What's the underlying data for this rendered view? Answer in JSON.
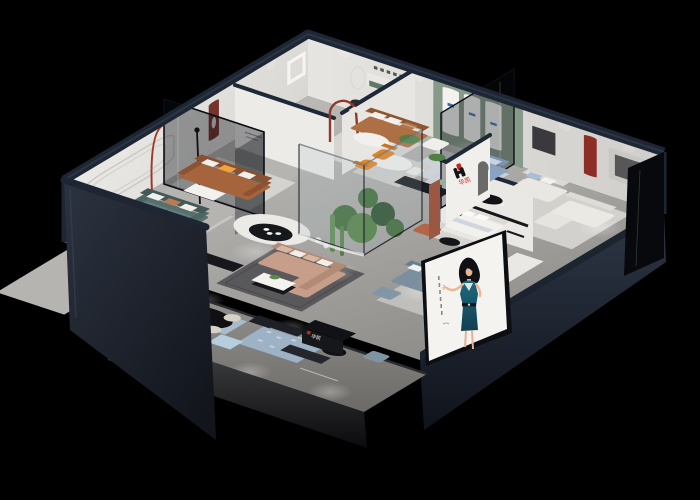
{
  "meta": {
    "title": "Furniture showroom 3D cutaway render",
    "style": "isometric dollhouse aerial view",
    "background": "#000000"
  },
  "brand": {
    "name": "华凯",
    "monogram": "geometric H mark",
    "colors": {
      "red": "#c5271f",
      "black": "#141414"
    },
    "wall_logo_text": "华凯",
    "counter_logo_text": "华凯"
  },
  "poster": {
    "subject": "fashion model illustration in teal evening dress",
    "dress_color": "#1e6a7f",
    "panel_color": "#f4f3f0",
    "location": "front-right facade"
  },
  "palette": {
    "wall_caps_navy": "#1f2836",
    "interior_walls": "#e9e8e4",
    "floor_gray": "#aaa9a6",
    "facade_dark": "#2b3342",
    "glass_tint": "#0d1117",
    "sage_wall": "#879a89",
    "maroon_niche": "#74332b",
    "terracotta": "#a6643c",
    "accent_orange": "#e08428",
    "teal_sofa": "#5b7472",
    "blush_sofa": "#c79e8a",
    "blue_sofa": "#8aa3c2",
    "brand_red": "#c5271f"
  },
  "rooms": [
    {
      "name": "teal-sofa-lounge",
      "items": "teal sofa, potted plants, round table, stadium wall relief"
    },
    {
      "name": "cognac-sofa-room",
      "items": "cognac leather sofa, maroon arch niche, black-white coffee table"
    },
    {
      "name": "top-leather-room",
      "items": "caramel sofa, green wall niche, sculpture pedestal, wall mirror"
    },
    {
      "name": "arch-gallery",
      "items": "sage wall with three arched panels, white armchair"
    },
    {
      "name": "blue-sofa-room",
      "items": "blue fabric sofa, sage chaise, dark media console"
    },
    {
      "name": "right-white-rooms",
      "items": "white sofas, red arch niche, black display shelf, dining set"
    },
    {
      "name": "brand-wall-room",
      "items": "logo partition wall, terracotta armchair, white daybed"
    },
    {
      "name": "central-lounge",
      "items": "blush sectional, coffee table, curved counter with black oval table, glass terrarium, orange dining chairs"
    },
    {
      "name": "front-terrace",
      "items": "reception counter, chrome benches, black oval dining table, display shelf, patterned rugs"
    }
  ]
}
